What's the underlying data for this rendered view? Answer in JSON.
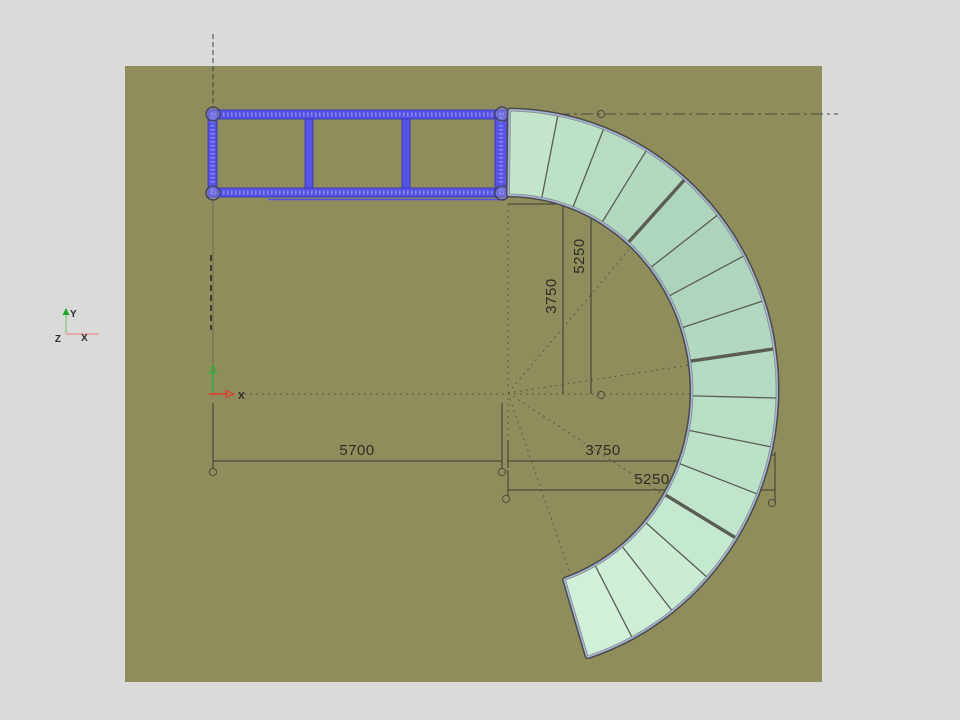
{
  "scene": {
    "background": "#dadada",
    "workplane_fill": "#8f8d5c",
    "selection_color": "#5753e4",
    "stair": {
      "segments": 16,
      "thick_divider_every": 4,
      "panel_fills": [
        "#c2e5cb",
        "#bde1c7",
        "#b7dcc3",
        "#b2d8c0",
        "#aed5bd",
        "#add3bc",
        "#afd5be",
        "#b2d8c1",
        "#b5dbc4",
        "#b8dec6",
        "#bce1c9",
        "#c0e4cc",
        "#c5e8d0",
        "#caebd4",
        "#ceeed7",
        "#d1f0da"
      ],
      "edge_band": "#a5b3da",
      "edge_outline": "#4c4c44",
      "divider_color": "#5c5d52"
    },
    "frame": {
      "bays": 3
    }
  },
  "dims": {
    "plan_width": "5700",
    "r_inner_h": "3750",
    "r_outer_h": "5250",
    "r_inner_v": "3750",
    "r_outer_v": "5250"
  },
  "axis_icons": {
    "world": {
      "x": "X",
      "y": "Y",
      "z": "Z"
    },
    "model": {
      "x": "X"
    }
  }
}
